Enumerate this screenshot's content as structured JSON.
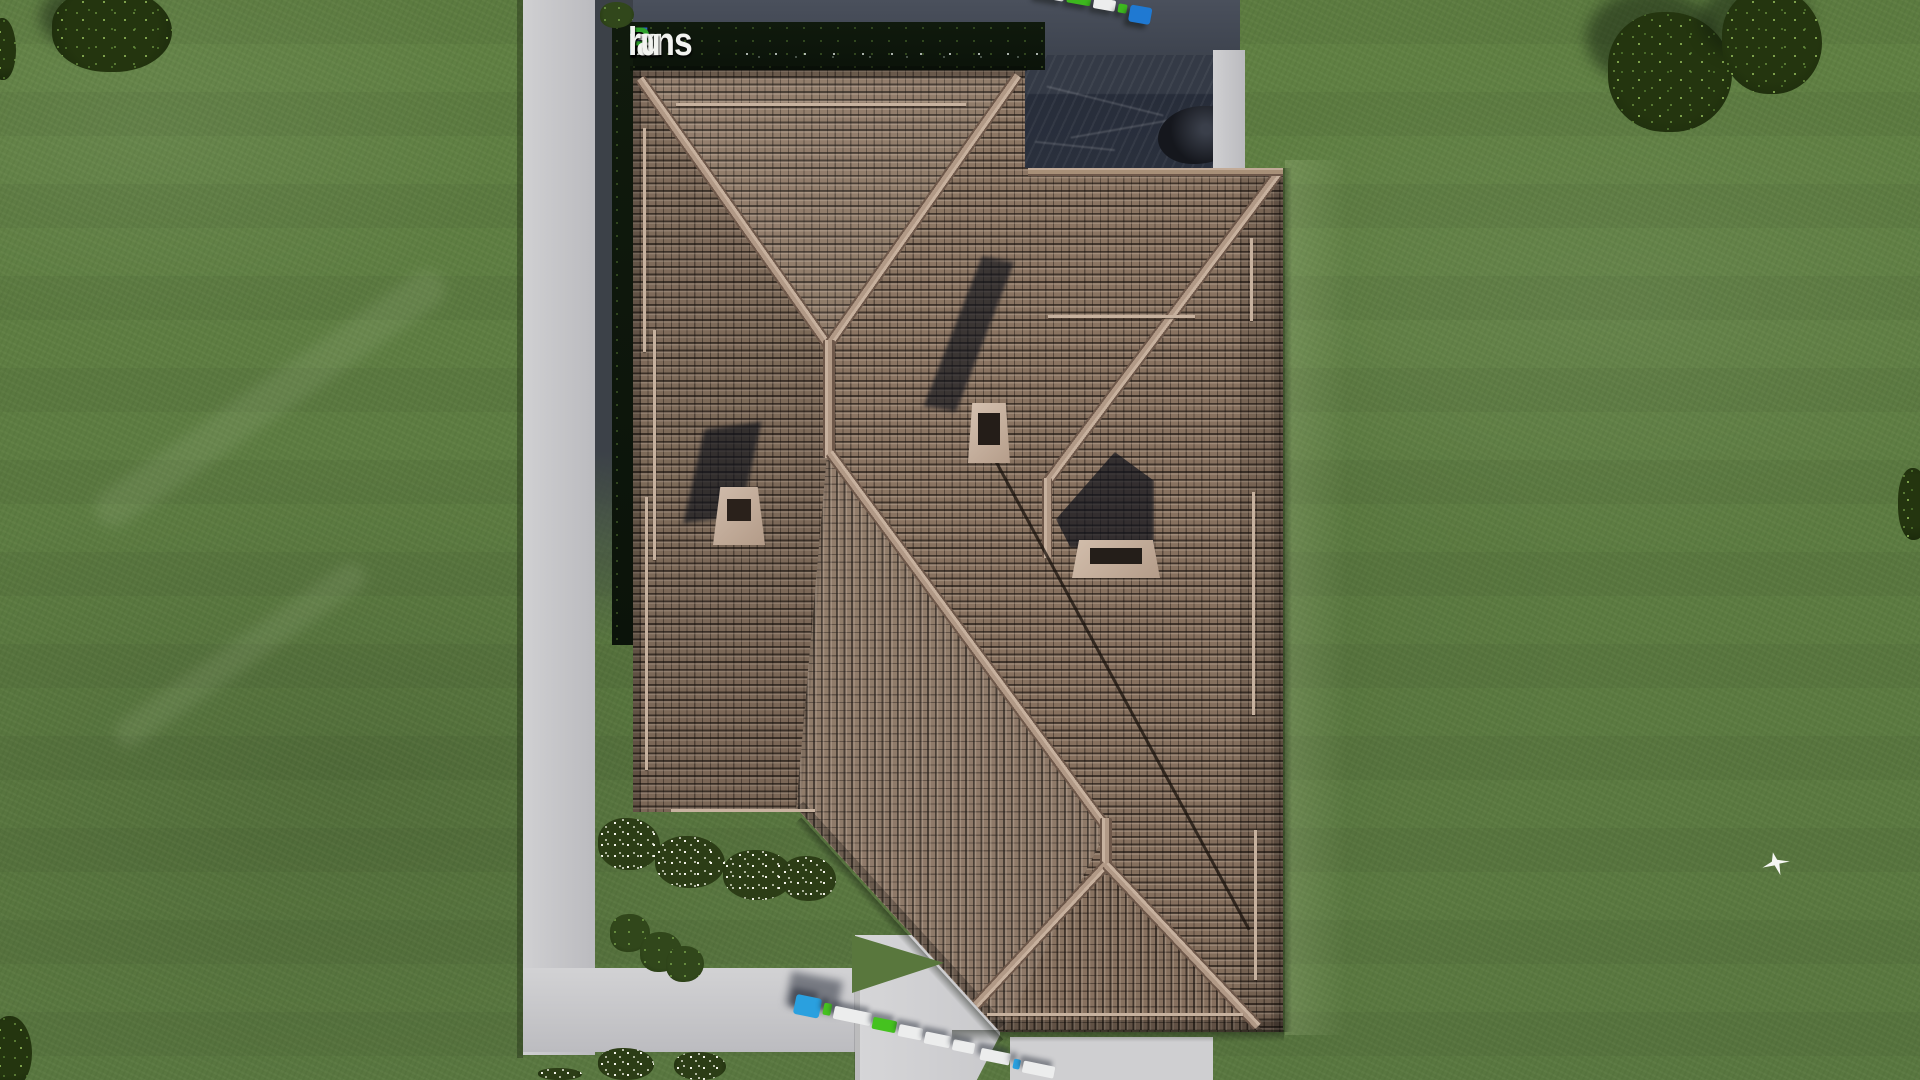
{
  "watermark": {
    "text": "FixPlans.ru",
    "segments": [
      {
        "text": "F",
        "color": "#2f63d2"
      },
      {
        "text": "ix",
        "color": "#f2f3f0"
      },
      {
        "text": "P",
        "color": "#2ea12c"
      },
      {
        "text": "lans",
        "color": "#f2f3f0"
      },
      {
        "text": ".",
        "color": "#2f63d2"
      },
      {
        "text": "ru",
        "color": "#f2f3f0"
      }
    ]
  },
  "scene": {
    "type": "aerial-3d-architectural-render",
    "subject": "Top-down view of a house hip roof with brown tiles on a green lawn, concrete paths, terrace, trees, flowering bushes, two delivery trucks and a flying bird",
    "palette": {
      "grass": "#5e7d41",
      "grass_dark": "#4c6834",
      "roof_tile": "#8a7462",
      "roof_gap": "#2f2822",
      "ridge_cap": "#c2ab99",
      "concrete": "#c9c9cb",
      "terrace": "#2c323e",
      "hedge": "#0e150c",
      "truck_blue": "#2aa0df",
      "truck_green": "#45c21f",
      "truck_white": "#eceded",
      "shadow": "#1c2128"
    },
    "objects": [
      "lawn",
      "mow-stripes",
      "house-roof",
      "ridge-caps",
      "chimney-left",
      "chimney-center",
      "chimney-right",
      "terrace",
      "bbq-grill",
      "hedge",
      "concrete-path-vertical",
      "walk-horizontal",
      "driveway",
      "porch-walk",
      "delivery-truck-top",
      "delivery-truck-bottom",
      "flower-bushes",
      "shrubs",
      "trees",
      "bird"
    ]
  }
}
